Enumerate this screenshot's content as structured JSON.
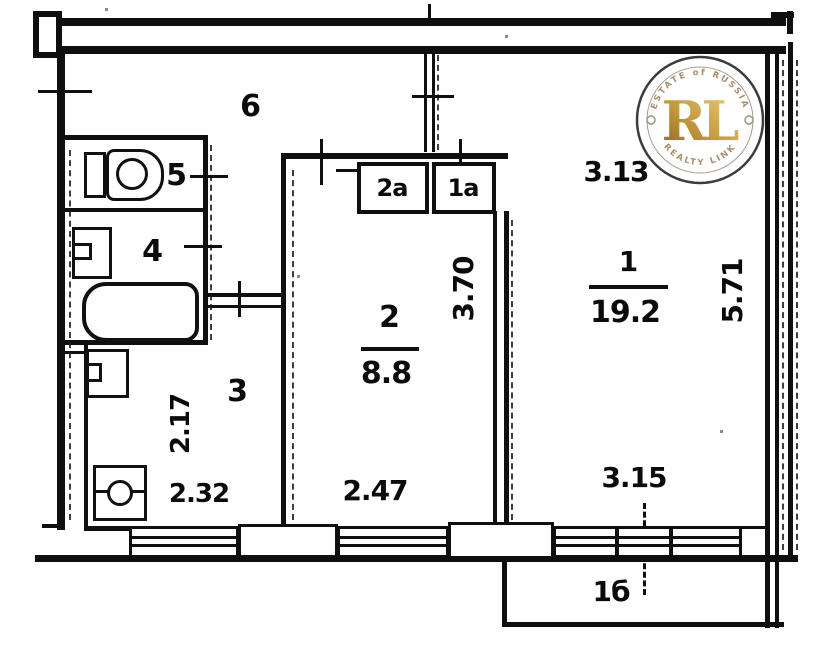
{
  "rooms": {
    "hallway": {
      "label": "6"
    },
    "wc": {
      "label": "5"
    },
    "bathroom": {
      "label": "4"
    },
    "kitchen": {
      "label": "3"
    },
    "room2": {
      "label": "2",
      "area": "8.8"
    },
    "room1": {
      "label": "1",
      "area": "19.2"
    },
    "closet2a": {
      "label": "2а"
    },
    "closet1a": {
      "label": "1а"
    },
    "balcony": {
      "label": "1б"
    }
  },
  "dimensions": {
    "room1_width": "3.13",
    "room1_depth": "5.71",
    "room1_window": "3.15",
    "room2_depth": "3.70",
    "room2_width": "2.47",
    "kitchen_depth": "2.17",
    "kitchen_width": "2.32"
  },
  "watermark": {
    "arc_top": "ESTATE of RUSSIA",
    "monogram": "RL",
    "arc_bottom": "REALTY LINK",
    "gold_dark": "#8a651c",
    "gold_light": "#eed47f",
    "ring_color": "#3c3c3c"
  },
  "colors": {
    "ink": "#0f0f0f",
    "paper": "#ffffff"
  }
}
